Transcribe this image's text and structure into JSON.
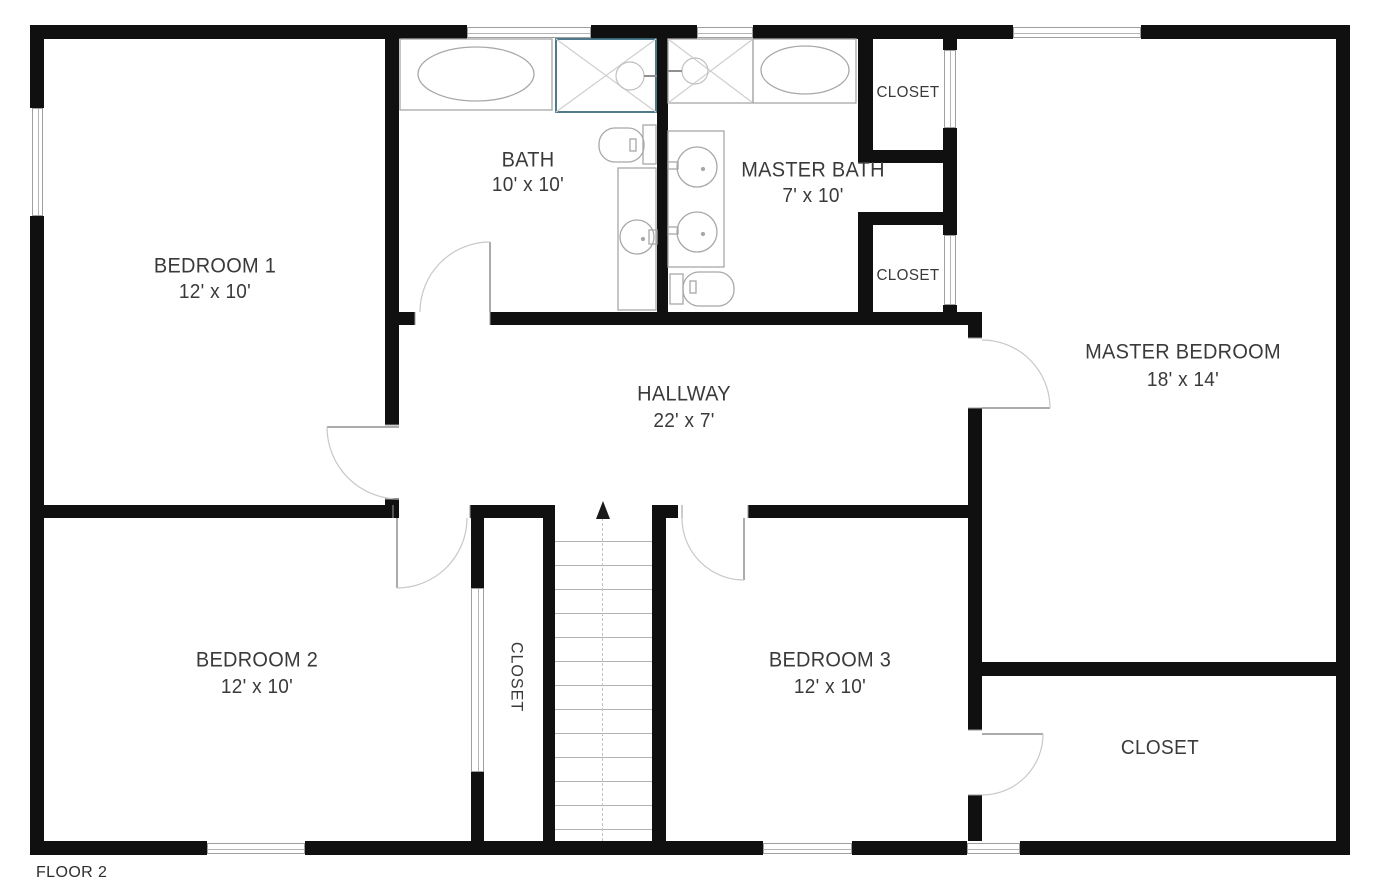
{
  "caption": "FLOOR 2",
  "rooms": {
    "bedroom1": {
      "name": "BEDROOM 1",
      "dims": "12' x 10'"
    },
    "bath": {
      "name": "BATH",
      "dims": "10' x 10'"
    },
    "master_bath": {
      "name": "MASTER BATH",
      "dims": "7' x 10'"
    },
    "master_bedroom": {
      "name": "MASTER BEDROOM",
      "dims": "18' x 14'"
    },
    "hallway": {
      "name": "HALLWAY",
      "dims": "22' x 7'"
    },
    "bedroom2": {
      "name": "BEDROOM 2",
      "dims": "12' x 10'"
    },
    "bedroom3": {
      "name": "BEDROOM 3",
      "dims": "12' x 10'"
    },
    "closet_master_bath_upper": {
      "name": "CLOSET"
    },
    "closet_master_bath_lower": {
      "name": "CLOSET"
    },
    "closet_bedroom2": {
      "name": "CLOSET"
    },
    "closet_master_bedroom": {
      "name": "CLOSET"
    }
  },
  "colors": {
    "wall": "#101010",
    "fixture_outline": "#a8a8a8",
    "door_arc": "#c8c8c8",
    "shower_accent": "#3b6b80",
    "text": "#3a3a3a"
  }
}
